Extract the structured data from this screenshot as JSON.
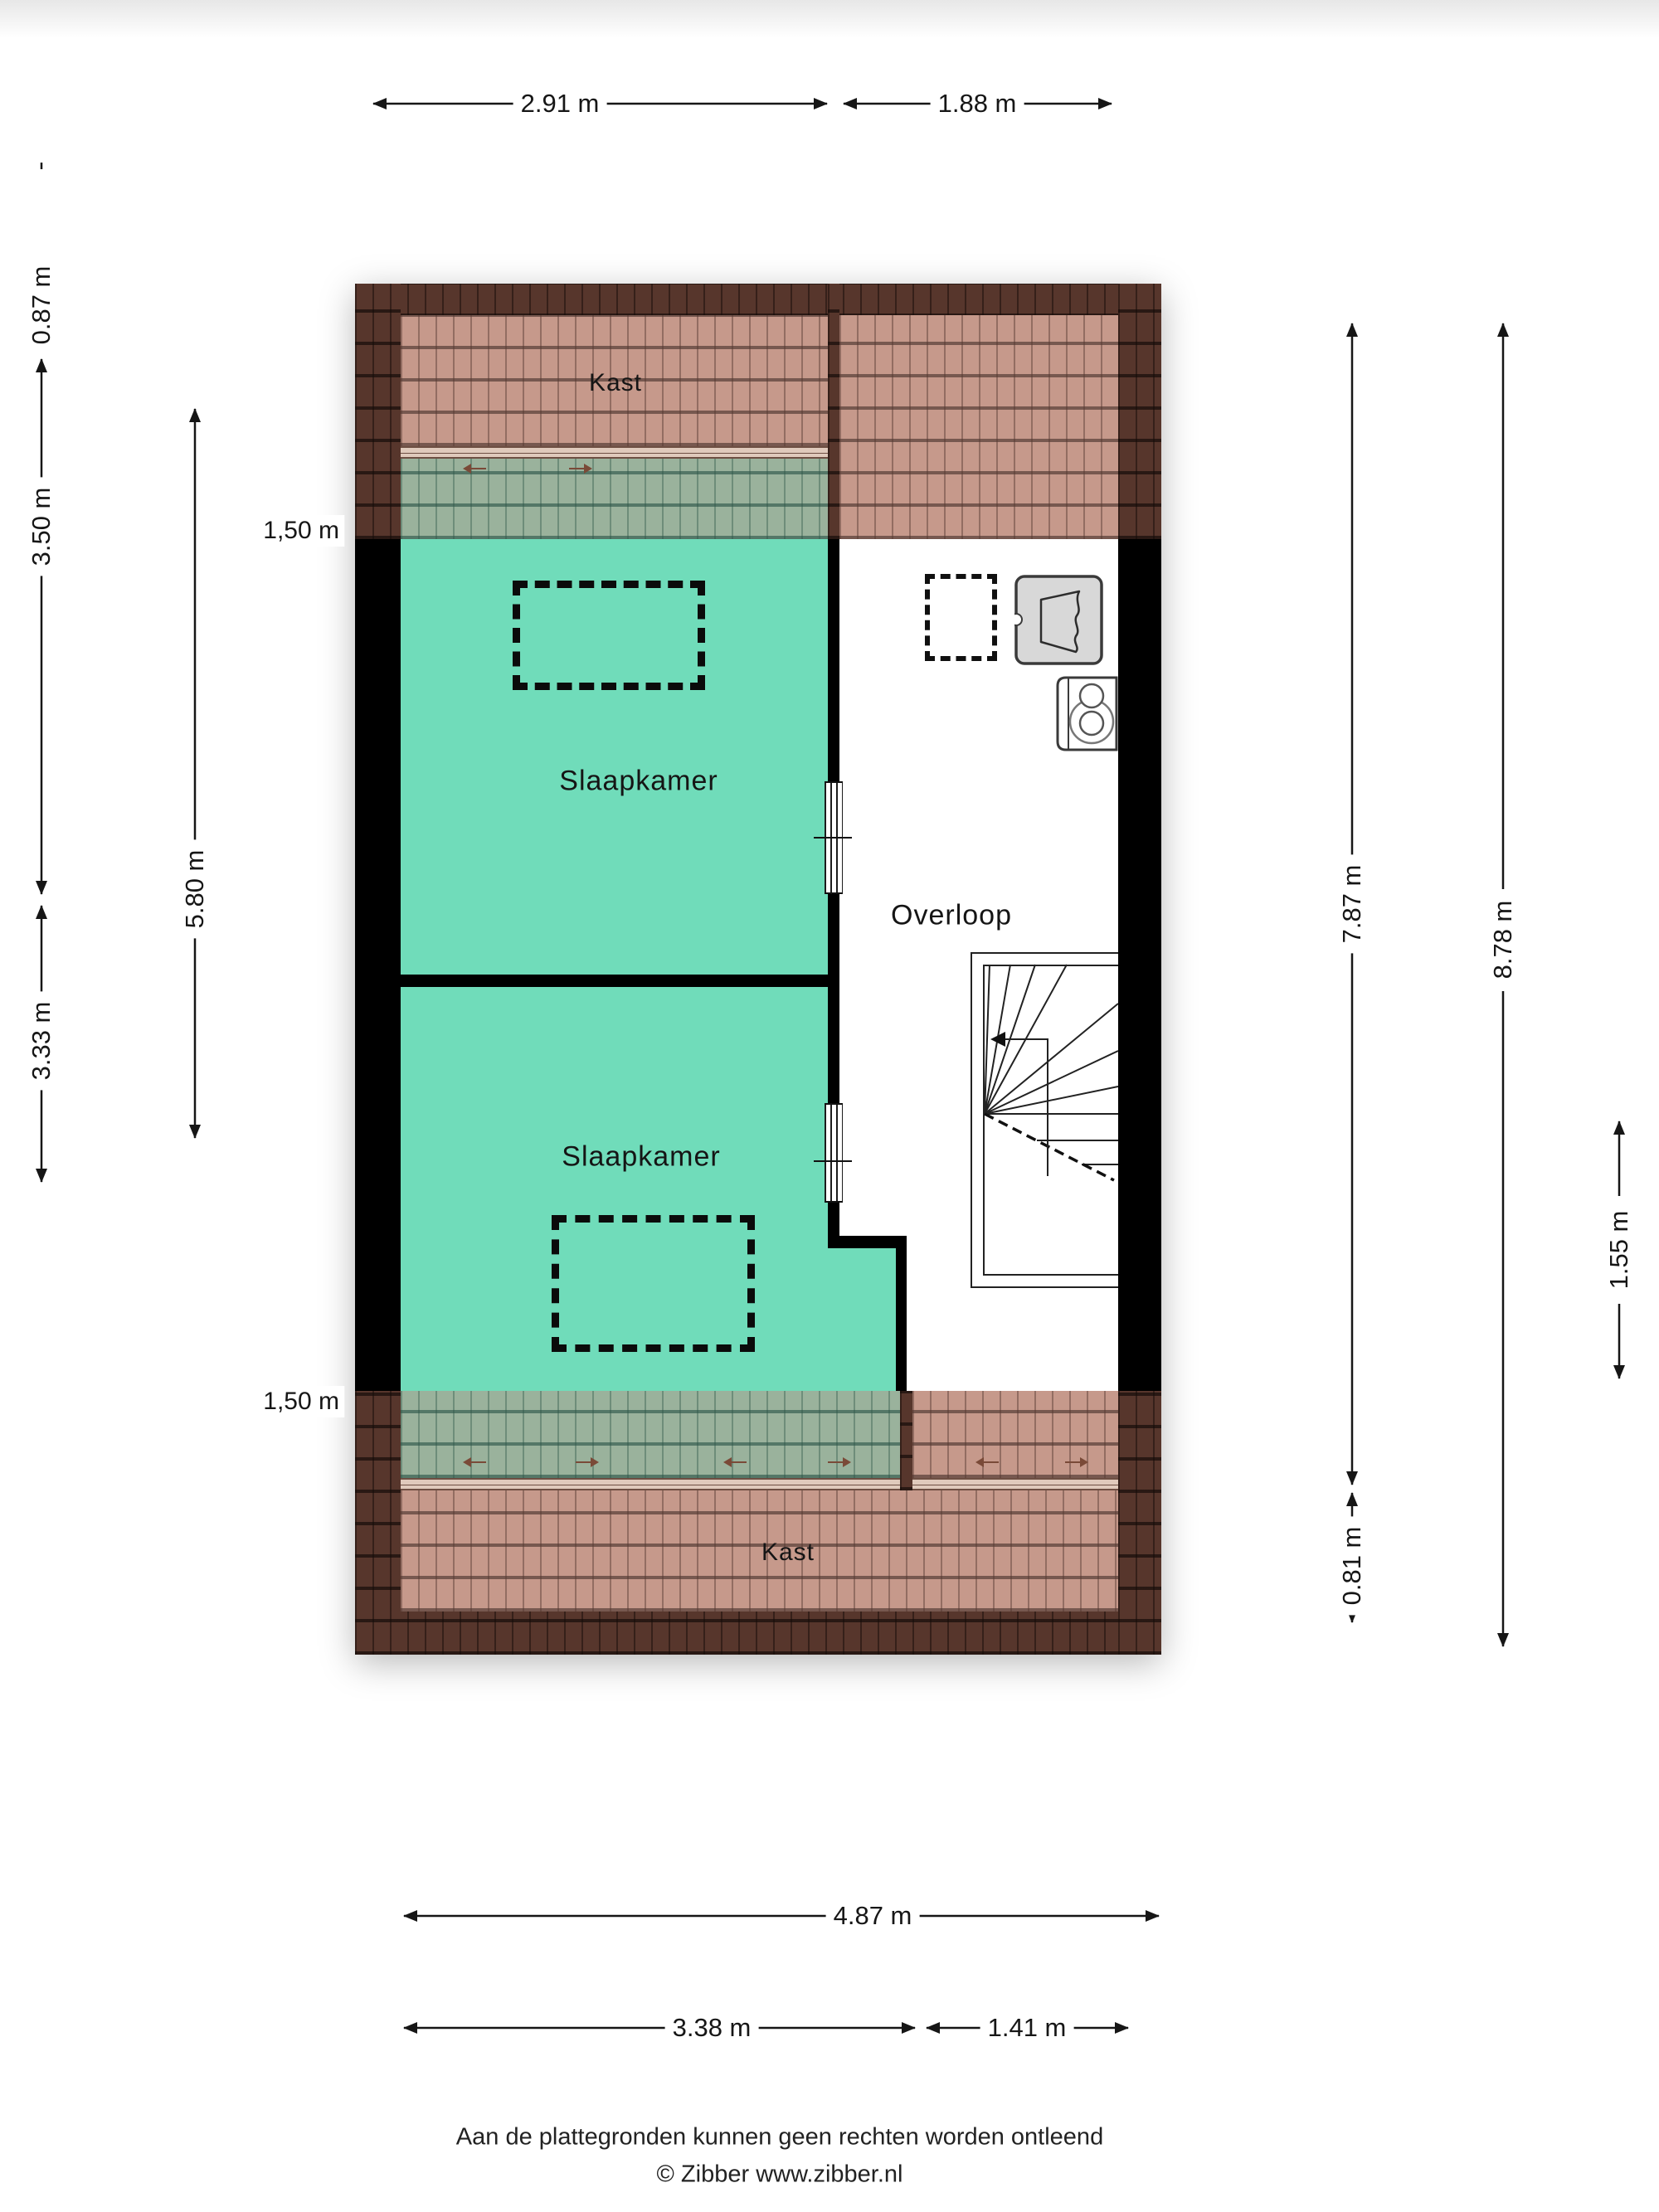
{
  "plan": {
    "type": "floorplan-attic",
    "rooms": {
      "kast_top": "Kast",
      "slaapkamer_1": "Slaapkamer",
      "slaapkamer_2": "Slaapkamer",
      "overloop": "Overloop",
      "kast_bottom": "Kast"
    }
  },
  "dimensions": {
    "top": {
      "left_width": "2.91 m",
      "right_width": "1.88 m"
    },
    "left": {
      "roof_top": "0.87 m",
      "room_top": "3.50 m",
      "room_bottom": "3.33 m",
      "inner_total": "5.80 m",
      "knee_top": "1,50 m",
      "knee_bottom": "1,50 m"
    },
    "right": {
      "inner_height": "7.87 m",
      "total_height": "8.78 m",
      "roof_bottom": "0.81 m",
      "stair_section": "1.55 m"
    },
    "bottom": {
      "total_width": "4.87 m",
      "left_width": "3.38 m",
      "right_width": "1.41 m"
    }
  },
  "footer": {
    "disclaimer": "Aan de plattegronden kunnen geen rechten worden ontleend",
    "copyright": "© Zibber www.zibber.nl"
  },
  "colors": {
    "room_fill": "#70dcba",
    "roof_tile": "#c6998b",
    "roof_edge": "#57362c",
    "roof_tinted": "#9ab29c",
    "wall": "#000000",
    "wardrobe_fill": "#d8d8d8",
    "dimension_text": "#161616"
  }
}
